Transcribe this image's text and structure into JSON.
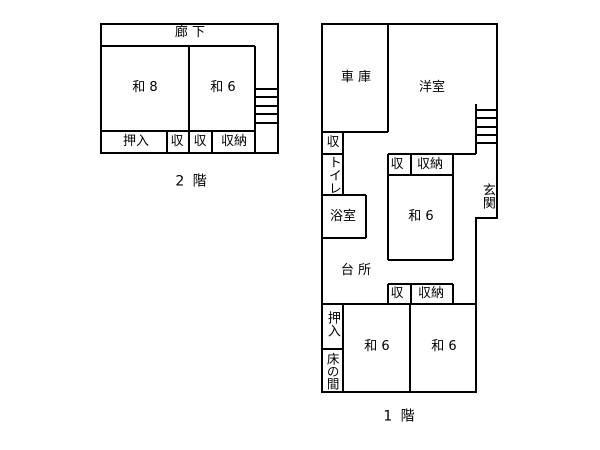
{
  "drawing": {
    "type": "floorplan",
    "colors": {
      "line": "#000000",
      "background": "#ffffff",
      "text": "#000000"
    }
  },
  "floor2": {
    "caption": "2 階",
    "corridor": "廊 下",
    "room_wa8": "和 8",
    "room_wa6": "和 6",
    "oshiire": "押入",
    "shu_left": "収",
    "shu_right": "収",
    "shuno": "収納"
  },
  "floor1": {
    "caption": "1 階",
    "garage": "車 庫",
    "western_room": "洋室",
    "shu_top": "収",
    "toilet": "トイレ",
    "bath": "浴室",
    "shu_upper": "収",
    "shuno_upper": "収納",
    "wa6_middle": "和 6",
    "genkan": "玄関",
    "kitchen": "台 所",
    "shu_lower": "収",
    "shuno_lower": "収納",
    "oshiire": "押入",
    "tokonoma": "床の間",
    "wa6_bottom_left": "和 6",
    "wa6_bottom_right": "和 6"
  }
}
